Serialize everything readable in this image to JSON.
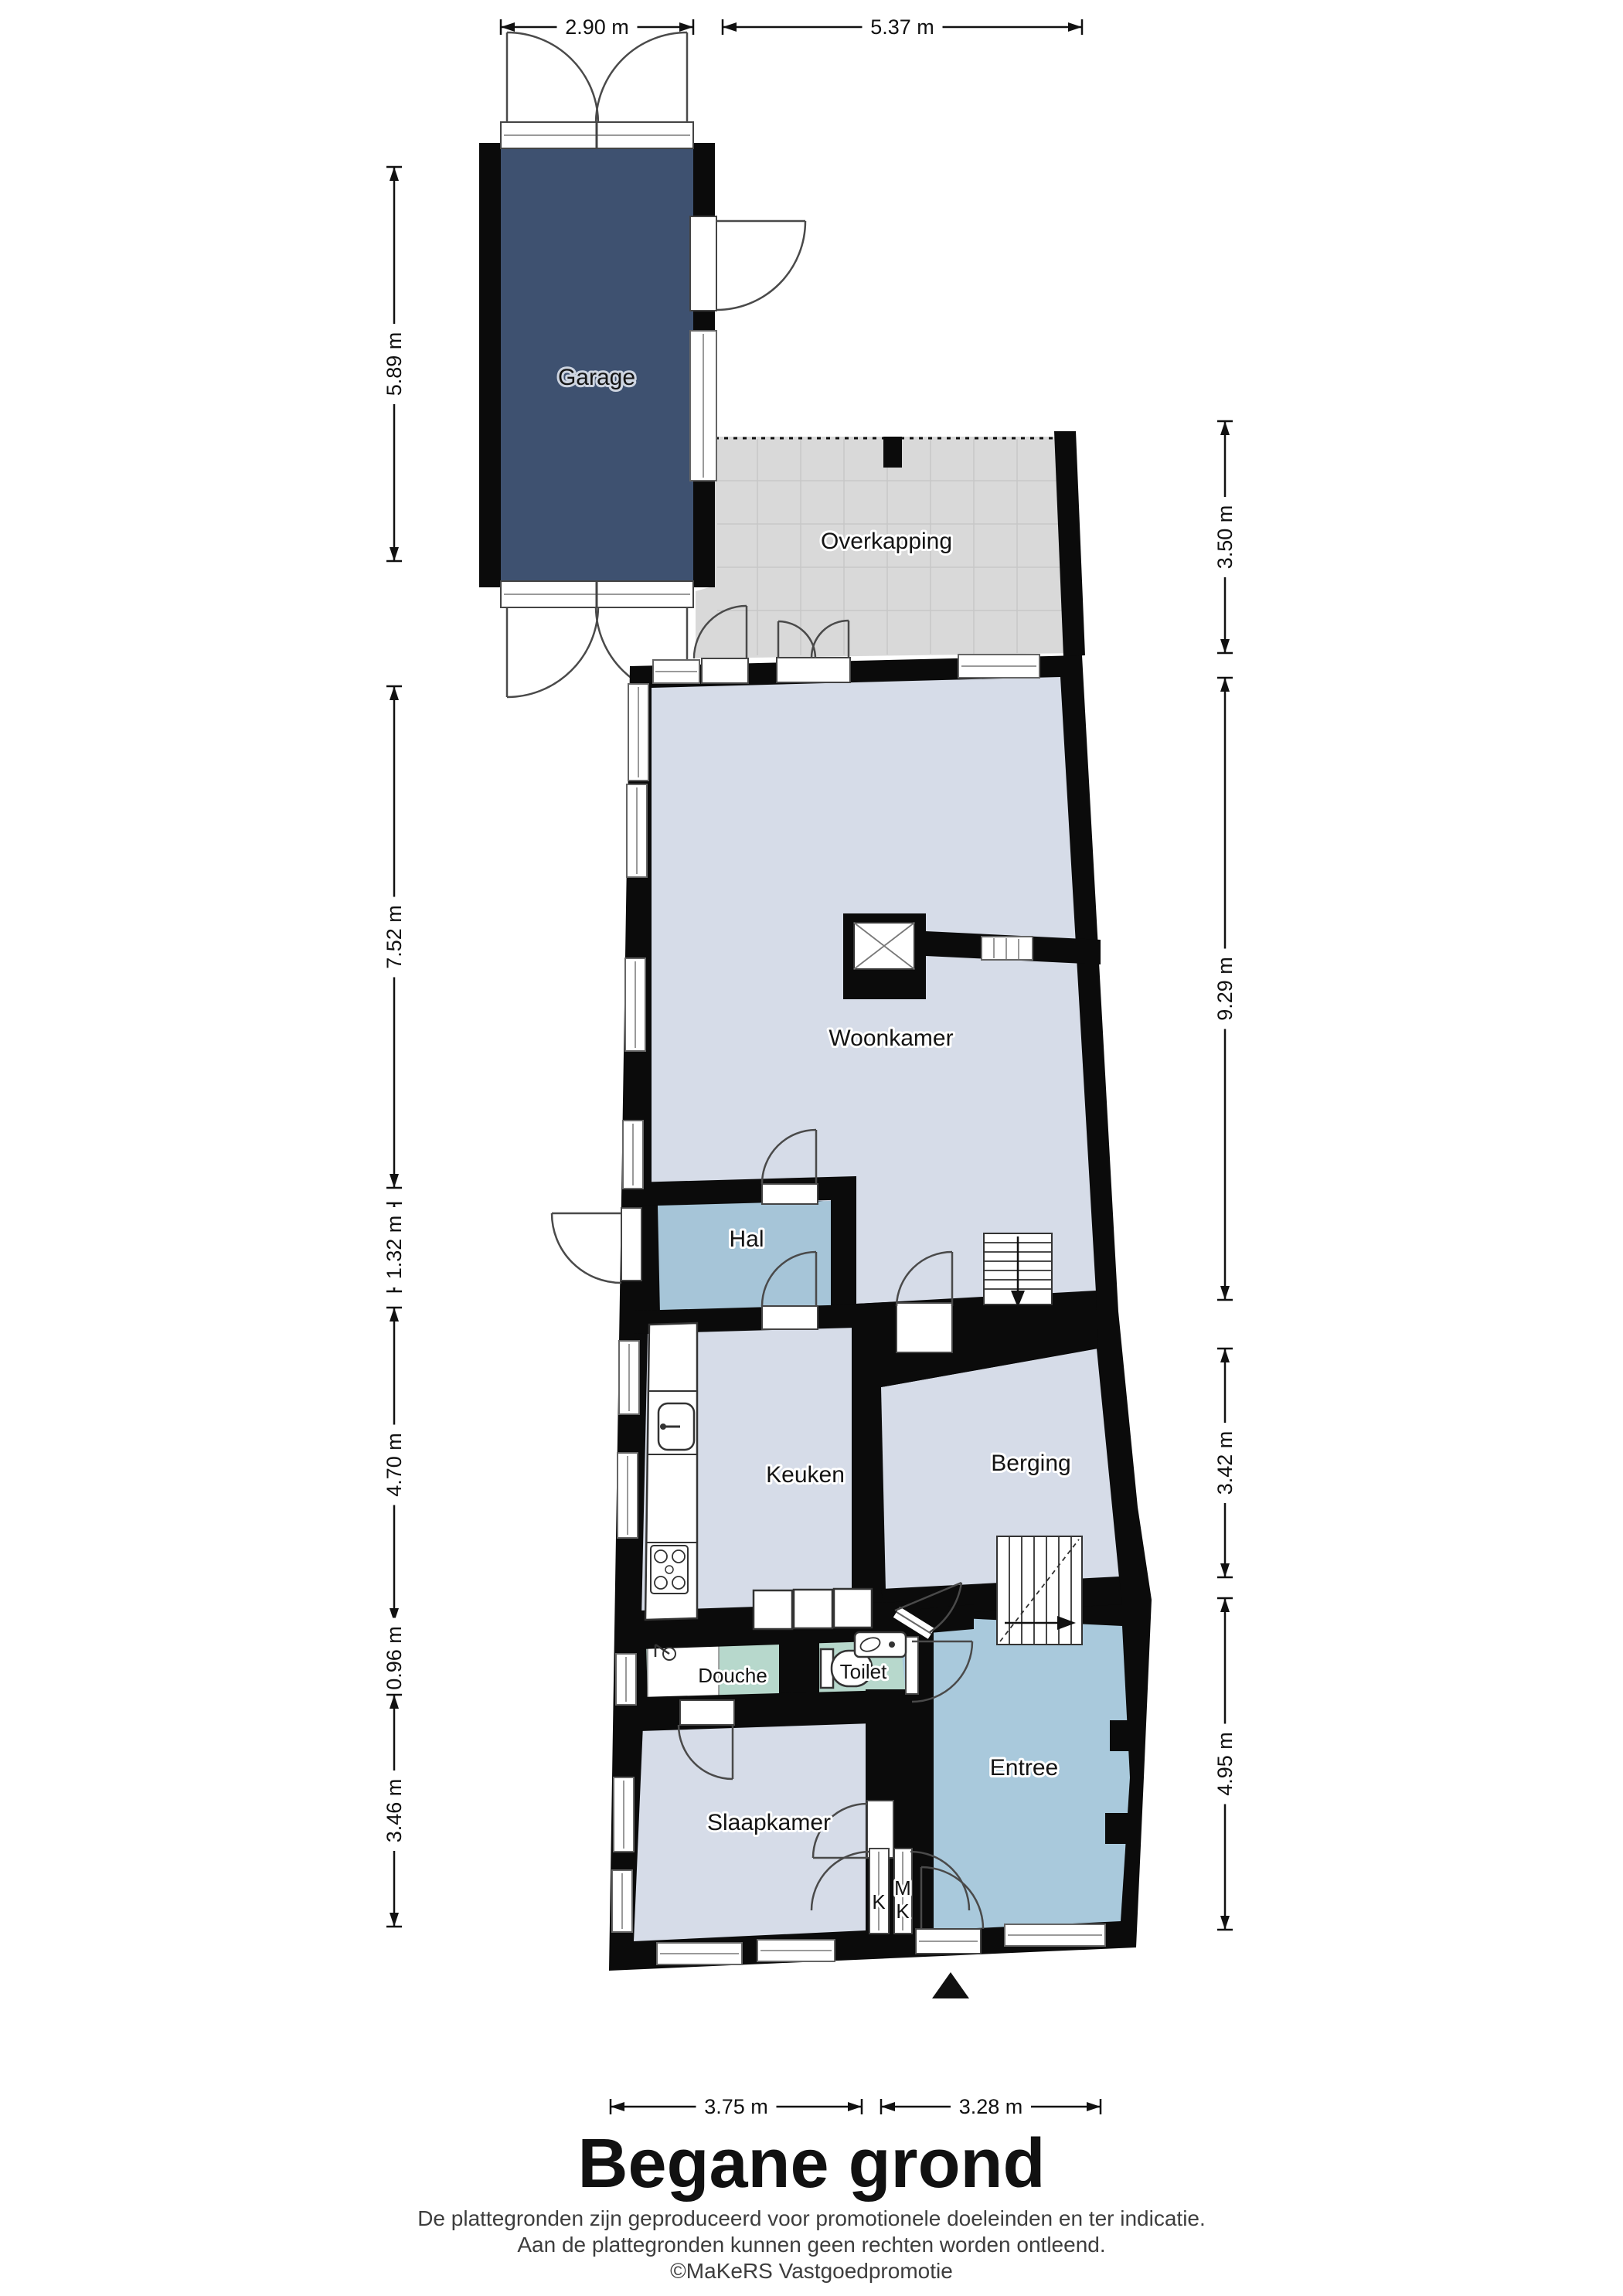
{
  "plan": {
    "title": "Begane grond",
    "disclaimer_line1": "De plattegronden zijn geproduceerd voor promotionele doeleinden en ter indicatie.",
    "disclaimer_line2": "Aan de plattegronden kunnen geen rechten worden ontleend.",
    "disclaimer_line3": "©MaKeRS Vastgoedpromotie"
  },
  "rooms": {
    "garage": "Garage",
    "overkapping": "Overkapping",
    "woonkamer": "Woonkamer",
    "hal": "Hal",
    "keuken": "Keuken",
    "berging": "Berging",
    "douche": "Douche",
    "toilet": "Toilet",
    "slaapkamer": "Slaapkamer",
    "entree": "Entree",
    "closet_k": "K",
    "meter_m": "M",
    "meter_k": "K"
  },
  "dims": {
    "top": [
      "2.90 m",
      "5.37 m"
    ],
    "left": [
      "5.89 m",
      "7.52 m",
      "1.32 m",
      "4.70 m",
      "0.96 m",
      "3.46 m"
    ],
    "right": [
      "3.50 m",
      "9.29 m",
      "3.42 m",
      "4.95 m"
    ],
    "bottom": [
      "3.75 m",
      "3.28 m"
    ]
  },
  "colors": {
    "wall": "#0b0b0b",
    "garage_floor": "#3e5170",
    "room_floor": "#d6dce8",
    "hall_floor": "#a6c5d8",
    "entree_floor": "#a9c9dc",
    "wet_floor": "#b7d8cc",
    "overkapping_floor": "#d9d9d9"
  }
}
